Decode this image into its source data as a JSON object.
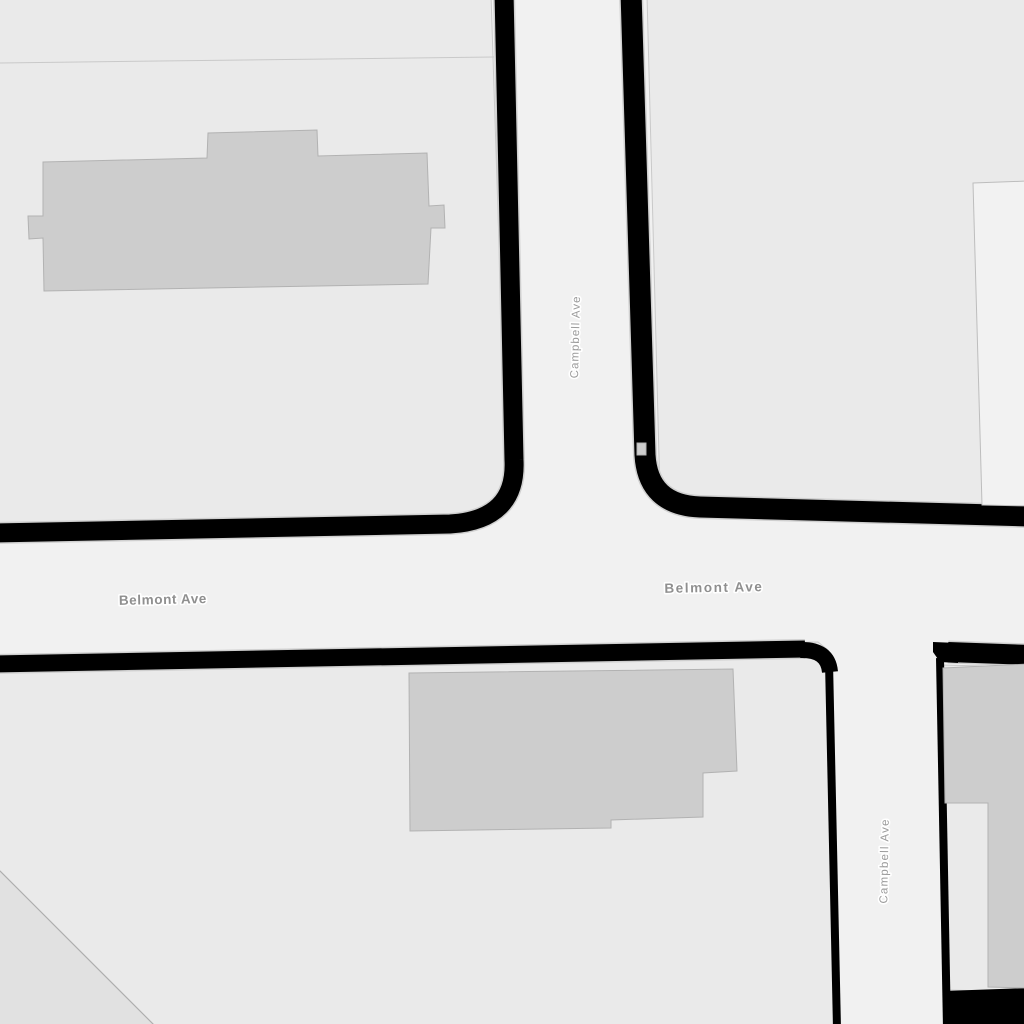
{
  "map": {
    "type": "street-map-tile",
    "style": "grayscale-toner",
    "labels": {
      "belmont_west": "Belmont Ave",
      "belmont_east": "Belmont Ave",
      "campbell_north": "Campbell Ave",
      "campbell_south": "Campbell Ave"
    },
    "streets": [
      {
        "name": "Campbell Ave",
        "orientation": "vertical"
      },
      {
        "name": "Belmont Ave",
        "orientation": "horizontal"
      }
    ],
    "colors": {
      "road": "#f1f1f1",
      "block": "#eaeaea",
      "block_border": "#c9c9c9",
      "building": "#cdcdcd",
      "building_border": "#b2b2b2",
      "building_light": "#f2f2f2",
      "building_light_border": "#bdbdbd",
      "casing": "#000000",
      "casing_edge": "#cfcfcf",
      "diagonal_area": "#e1e1e1",
      "diagonal_line": "#aeaeae",
      "label": "#8f8f8f",
      "label_secondary": "#9b9b9b"
    }
  }
}
